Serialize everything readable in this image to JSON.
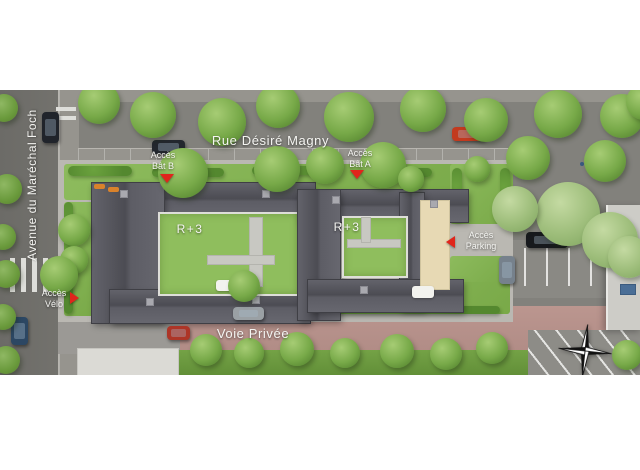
{
  "plan_type": "residence-site-plan",
  "streets": {
    "top": "Rue Désiré Magny",
    "left": "Avenue du Maréchal Foch",
    "private": "Voie Privée"
  },
  "buildings": [
    {
      "id": "bat-b",
      "label": "R+3"
    },
    {
      "id": "bat-a",
      "label": "R+3"
    }
  ],
  "access_points": [
    {
      "id": "bat-b",
      "line1": "Accès",
      "line2": "Bât B",
      "direction": "down"
    },
    {
      "id": "bat-a",
      "line1": "Accès",
      "line2": "Bât A",
      "direction": "down"
    },
    {
      "id": "parking",
      "line1": "Accès",
      "line2": "Parking",
      "direction": "left"
    },
    {
      "id": "velo",
      "line1": "Accès",
      "line2": "Vélo",
      "direction": "right"
    }
  ],
  "compass": {
    "icon": "compass-rose",
    "points": 4
  },
  "colors": {
    "marker_red": "#e0251c",
    "roof_dark": "#54545b",
    "green_roof": "#8fbe5d",
    "lawn_green": "#84b254",
    "road_asphalt": "#82817c",
    "avenue_asphalt": "#6f6e6a",
    "private_road_pink": "#b5918a",
    "ramp_beige": "#e7d9b4",
    "label_text": "#f5f5f2"
  }
}
